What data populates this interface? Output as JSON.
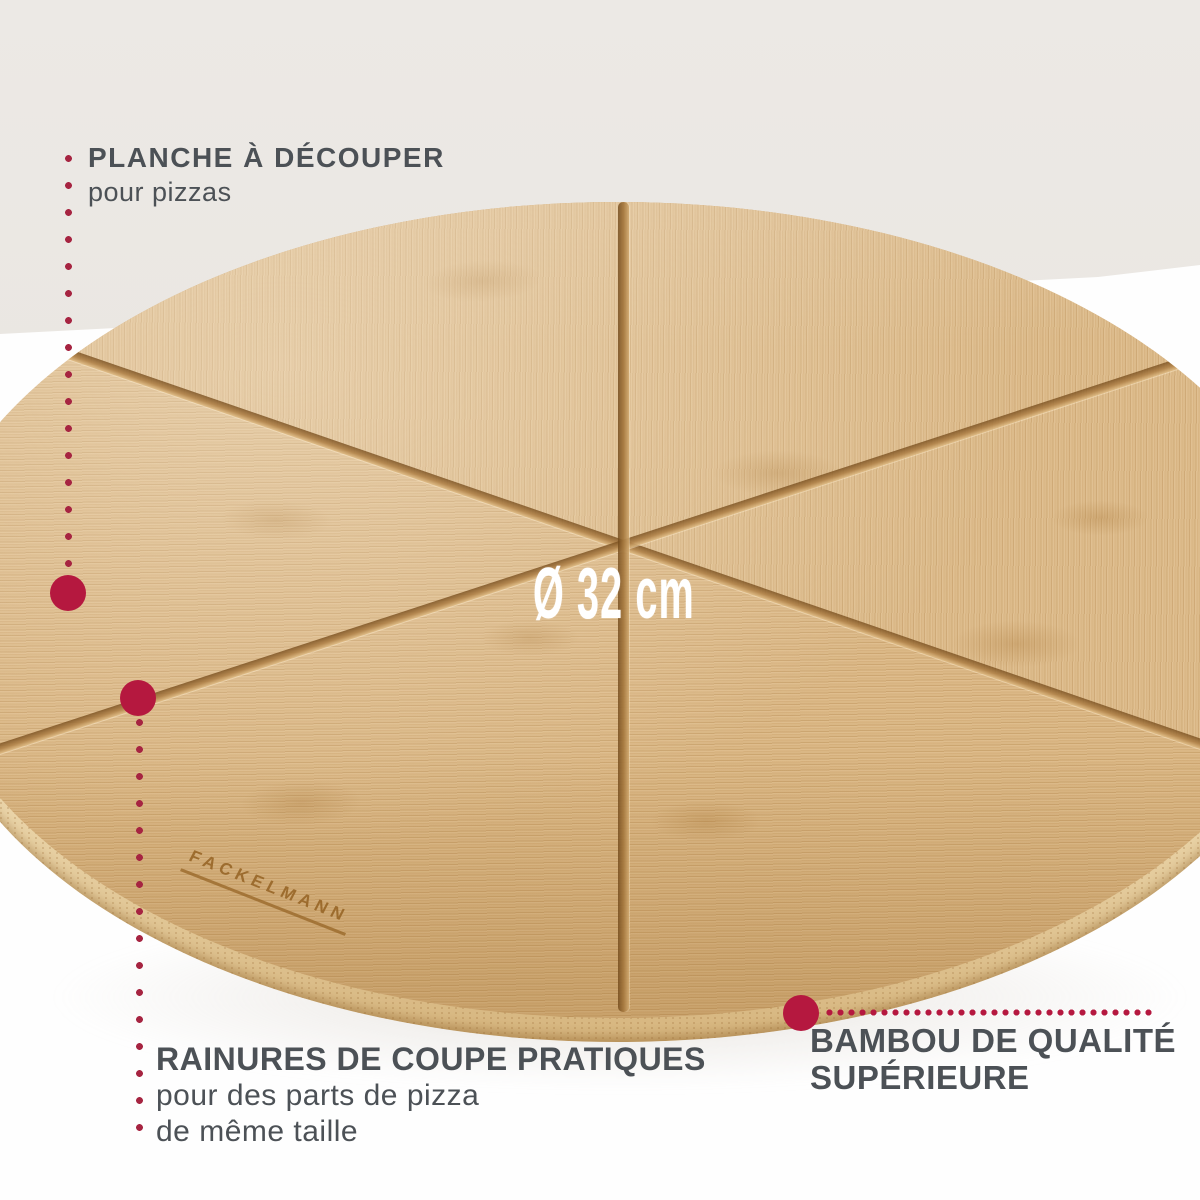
{
  "product": {
    "brand_engraving": "FACKELMANN",
    "diameter_label": "Ø 32 cm"
  },
  "callouts": {
    "cutting_board": {
      "title": "PLANCHE À DÉCOUPER",
      "subtitle": "pour pizzas"
    },
    "grooves": {
      "title": "RAINURES DE COUPE PRATIQUES",
      "subtitle_line1": "pour des parts de pizza",
      "subtitle_line2": "de même taille"
    },
    "bamboo": {
      "title_line1": "BAMBOU DE QUALITÉ",
      "title_line2": "SUPÉRIEURE"
    }
  },
  "colors": {
    "accent_red": "#b5183f",
    "dot_red": "#a62441",
    "text_gray": "#4c5156",
    "background_top": "#eae7e3",
    "background_bottom": "#fefefe",
    "wood": "#dcba8a",
    "groove_brown": "#a5783e"
  }
}
